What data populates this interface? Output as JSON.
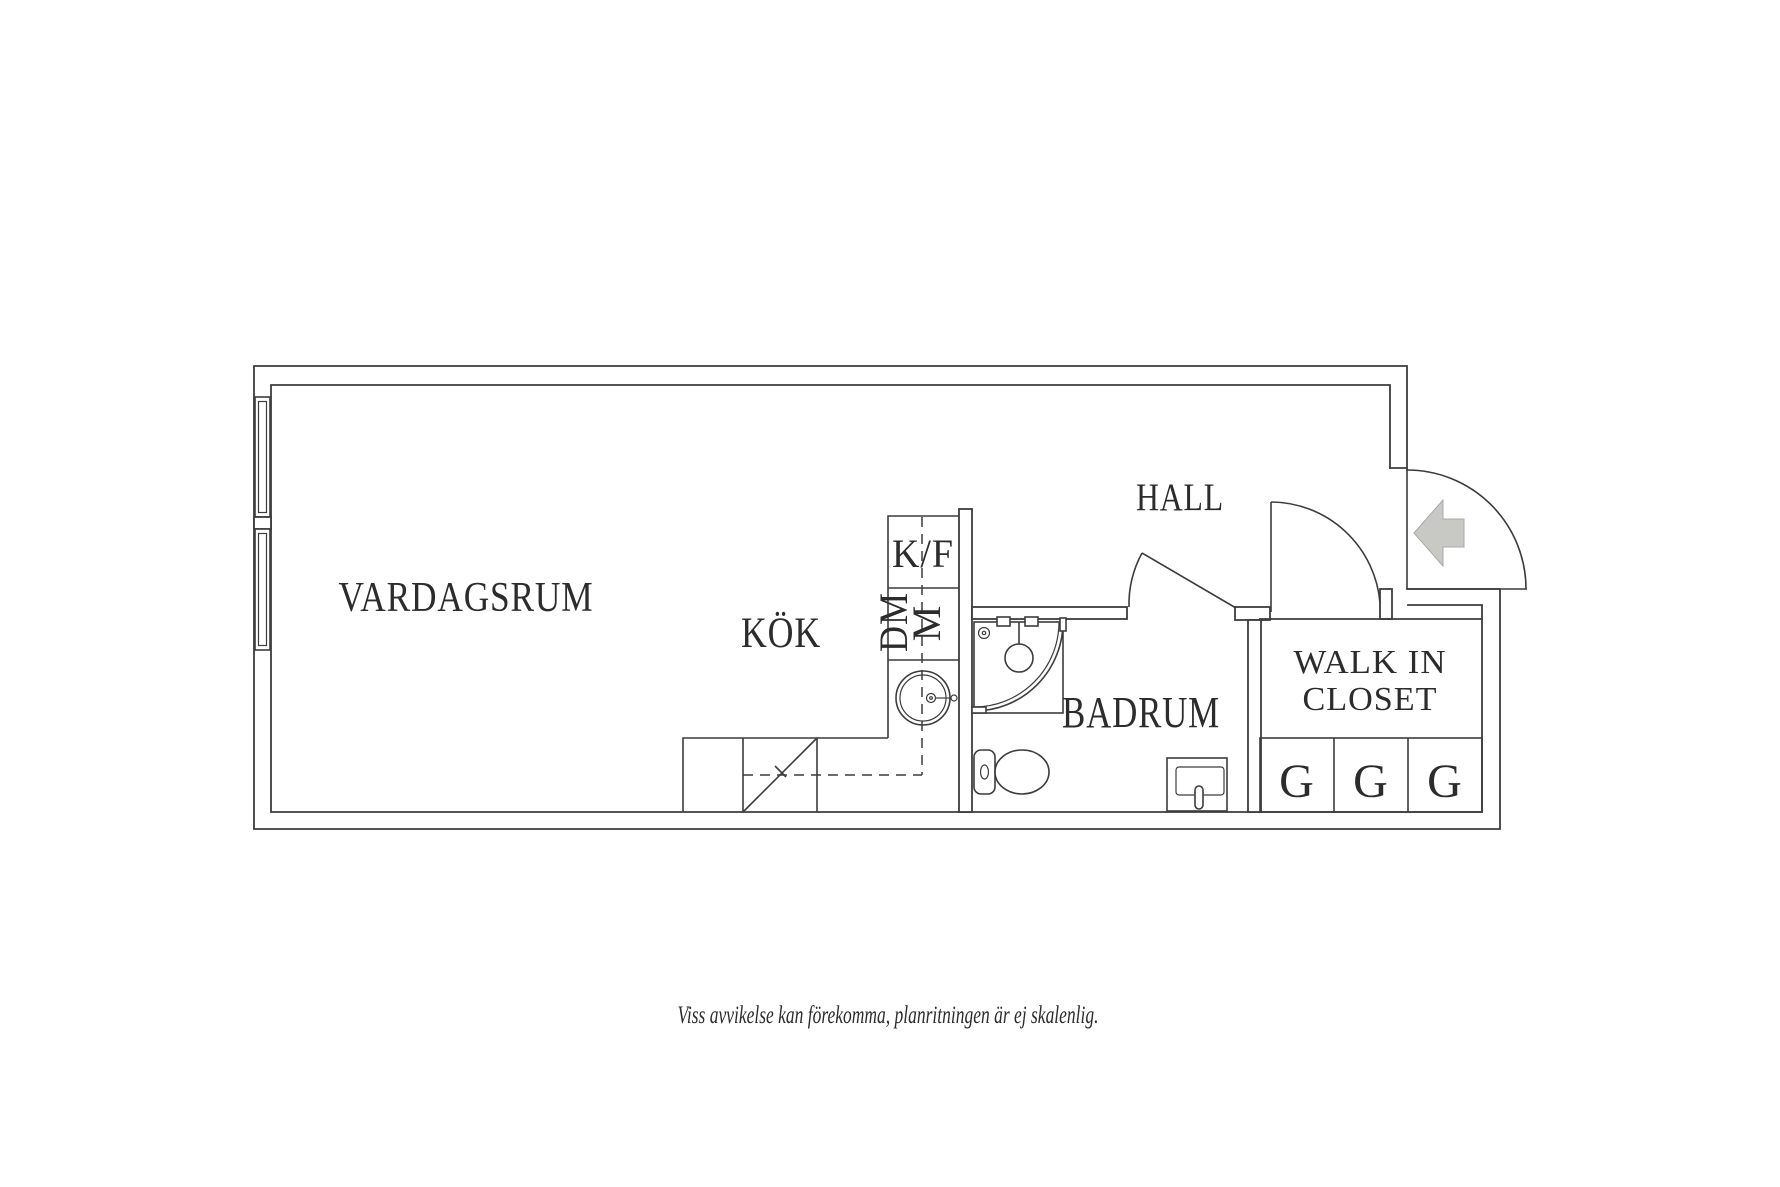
{
  "plan": {
    "rooms": {
      "vardagsrum": {
        "label": "VARDAGSRUM"
      },
      "kok": {
        "label": "KÖK"
      },
      "hall": {
        "label": "HALL"
      },
      "badrum": {
        "label": "BADRUM"
      },
      "walk_in_closet": {
        "label_line1": "WALK IN",
        "label_line2": "CLOSET"
      }
    },
    "fixtures": {
      "fridge_freezer": "K/F",
      "dishwasher": "DM",
      "microwave": "M"
    },
    "wardrobes": [
      "G",
      "G",
      "G"
    ]
  },
  "footer": {
    "disclaimer": "Viss avvikelse kan förekomma, planritningen är ej skalenlig."
  },
  "colors": {
    "line": "#3c3c3c",
    "text": "#2c2c2c",
    "arrow_fill": "#c8c8c5",
    "arrow_stroke": "#a9a9a6",
    "background": "#ffffff"
  }
}
